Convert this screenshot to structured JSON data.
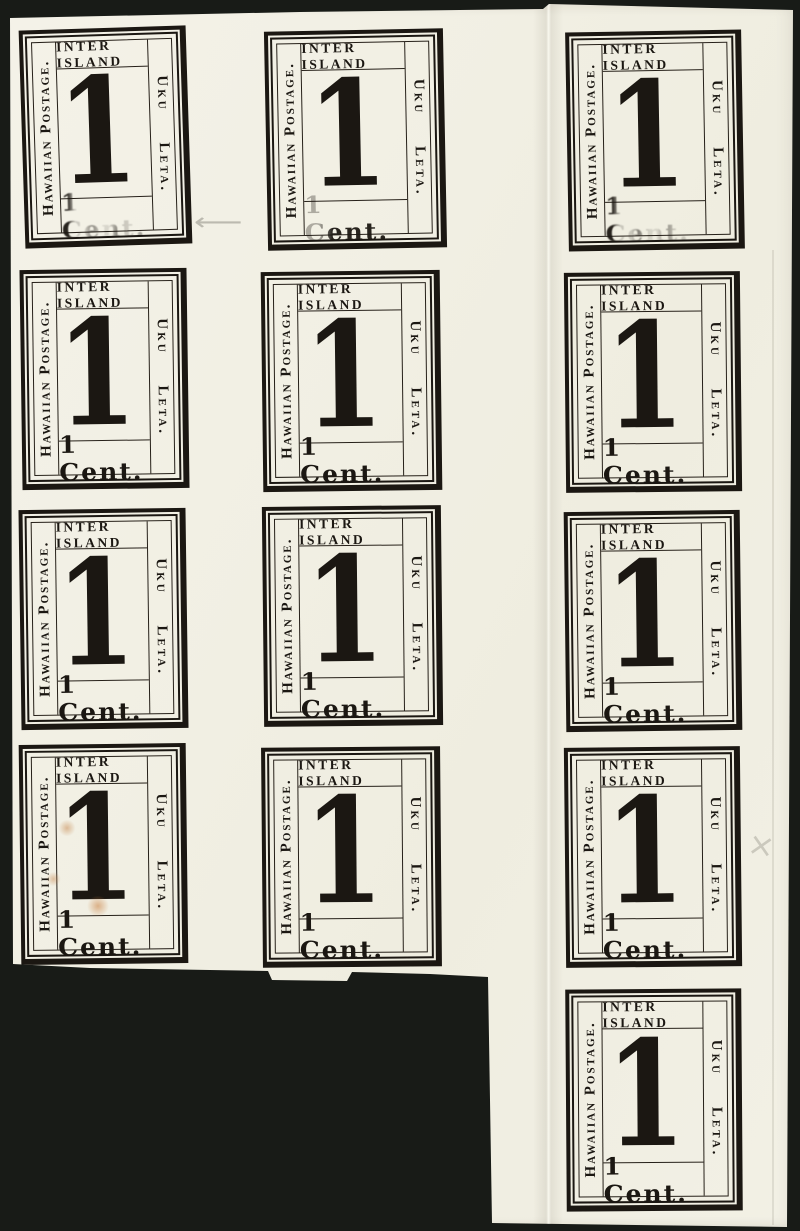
{
  "colors": {
    "background": "#181b17",
    "paper": "#f2f0e4",
    "ink": "#1b1712",
    "stain": "#c48246",
    "pencil": "#737068"
  },
  "stamp_design": {
    "top_label": "INTER ISLAND",
    "left_label": "Hawaiian Postage.",
    "right_label": "Uku Leta.",
    "numeral": "1",
    "denomination": "1 Cent."
  },
  "sheet": {
    "stamp_count": 13,
    "grid": [
      {
        "row": 1,
        "stamps": [
          {
            "col": 1,
            "denomination_worn": "heavy"
          },
          {
            "col": 2,
            "denomination_worn": "light"
          },
          {
            "col": 3,
            "denomination_worn": "heavy"
          }
        ]
      },
      {
        "row": 2,
        "stamps": [
          {
            "col": 1
          },
          {
            "col": 2
          },
          {
            "col": 3
          }
        ]
      },
      {
        "row": 3,
        "stamps": [
          {
            "col": 1
          },
          {
            "col": 2
          },
          {
            "col": 3
          }
        ]
      },
      {
        "row": 4,
        "stamps": [
          {
            "col": 1,
            "stained": true
          },
          {
            "col": 2
          },
          {
            "col": 3
          }
        ]
      },
      {
        "row": 5,
        "stamps": [
          {
            "col": 3
          }
        ]
      }
    ],
    "features": [
      "vertical fold between middle and right columns",
      "cut-out notch at bottom left of tail",
      "orange stains on row-4 column-1 stamp"
    ]
  },
  "annotations": {
    "pencil_arrow": "⟵",
    "pencil_cross": "×"
  }
}
